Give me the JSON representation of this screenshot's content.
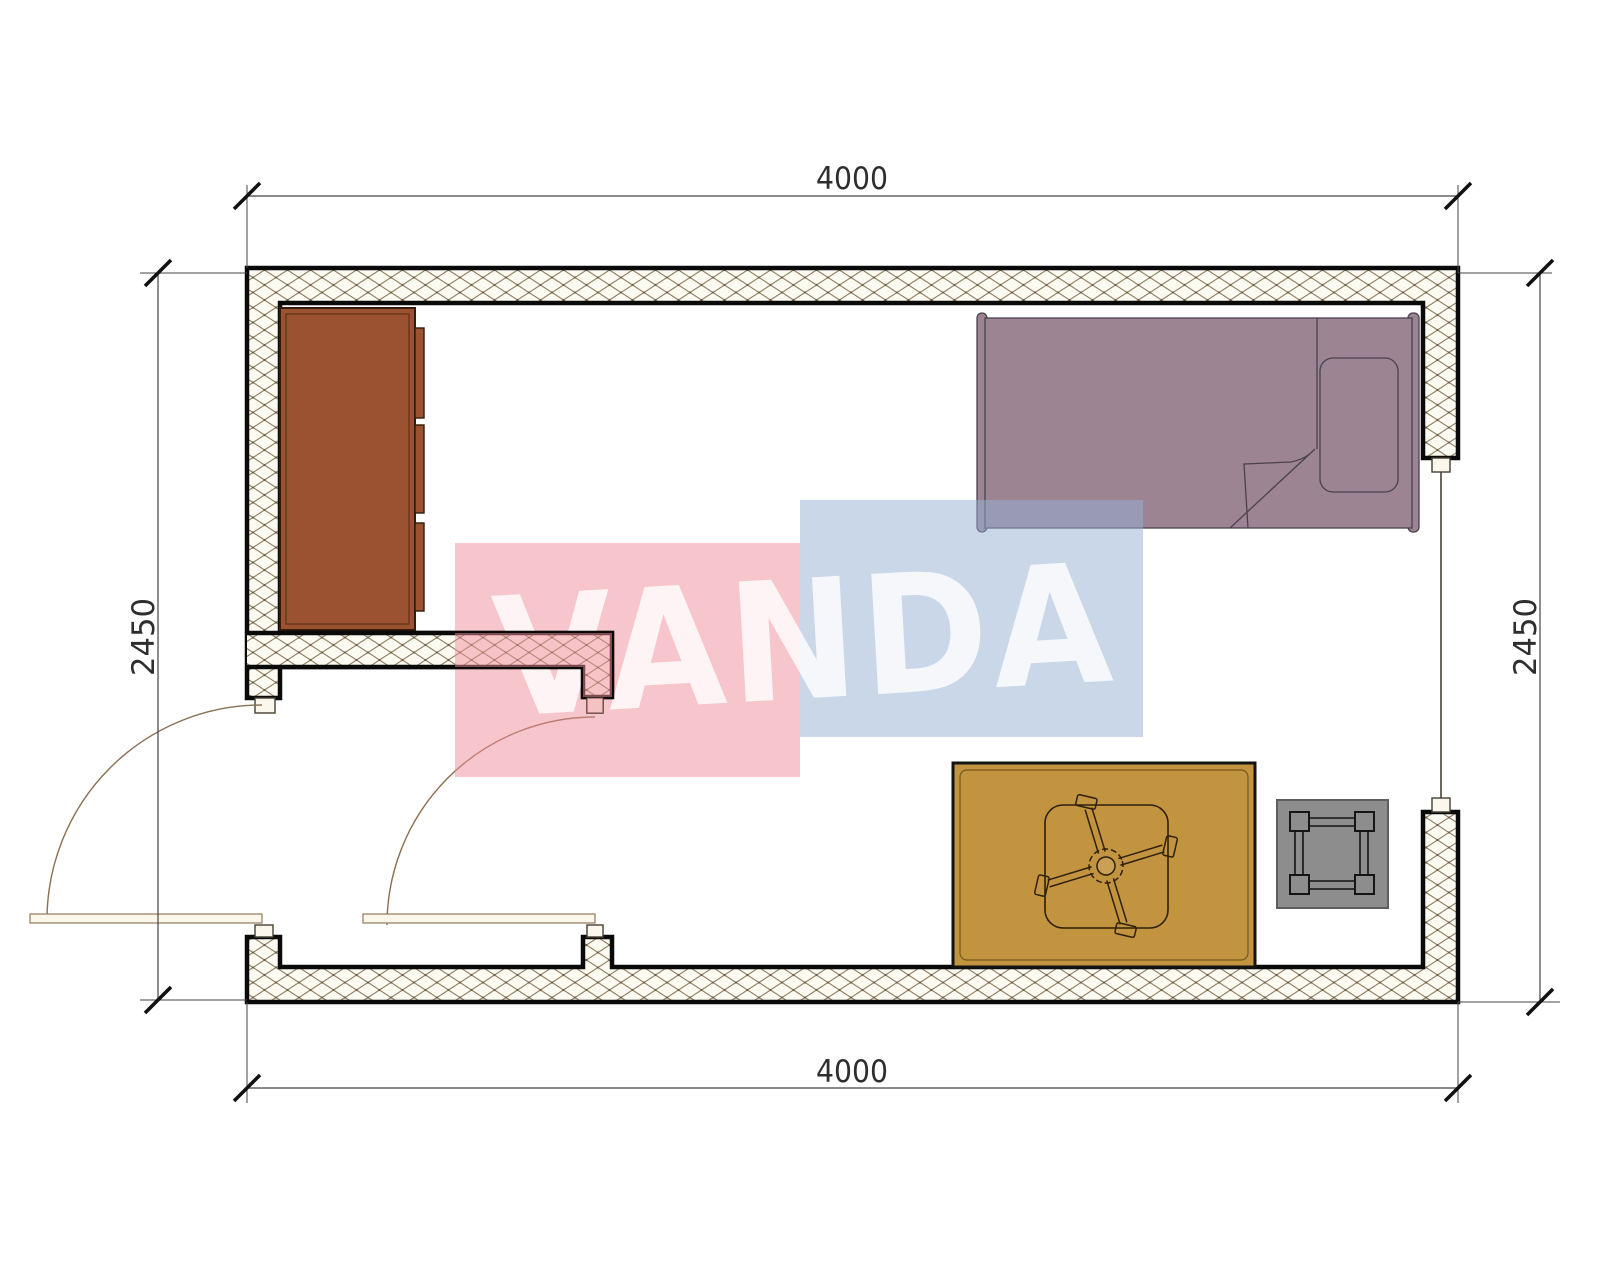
{
  "watermark": {
    "text": "VANDA",
    "pink_color": "#EF8D99",
    "blue_color": "#96B0D4",
    "text_color": "#FFFFFF"
  },
  "dimensions": {
    "top": "4000",
    "bottom": "4000",
    "left": "2450",
    "right": "2450"
  },
  "palette": {
    "wall_line": "#0a0a0a",
    "hatch_line": "#8e7f63",
    "hatch_bg": "#fdfaf2",
    "wardrobe": "#9A5230",
    "bed": "#9D8492",
    "pillow_line": "#4a4150",
    "rug": "#C29440",
    "chair_line": "#2e2008",
    "stool": "#8D8D8D",
    "door_line": "#8a6f52",
    "door_leaf": "#fcf7ea",
    "window_line": "#4a4238",
    "dim_line": "#444444",
    "tick": "#111111"
  }
}
